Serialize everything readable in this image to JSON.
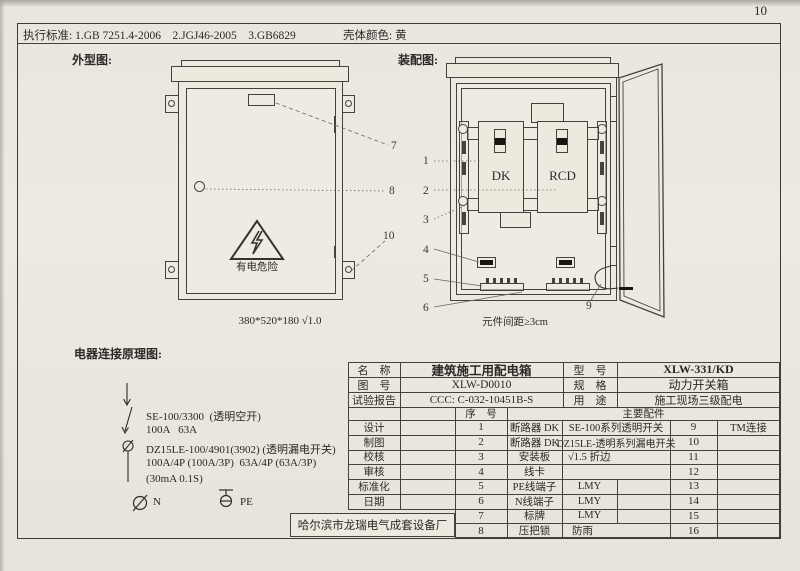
{
  "page": {
    "number": "10"
  },
  "header": {
    "standards": "执行标准: 1.GB 7251.4-2006    2.JGJ46-2005    3.GB6829",
    "shell_color": "壳体颜色: 黄"
  },
  "exterior": {
    "title": "外型图:",
    "warning": "有电危险",
    "dimension": "380*520*180 √1.0"
  },
  "assembly": {
    "title": "装配图:",
    "dk": "DK",
    "rcd": "RCD",
    "note": "元件间距≥3cm"
  },
  "callouts": {
    "c1": "1",
    "c2": "2",
    "c3": "3",
    "c4": "4",
    "c5": "5",
    "c6": "6",
    "c7": "7",
    "c8": "8",
    "c9": "9",
    "c10": "10"
  },
  "schematic": {
    "title": "电器连接原理图:",
    "lines": [
      "SE-100/3300  (透明空开)",
      "100A   63A",
      "DZ15LE-100/4901(3902) (透明漏电开关)",
      "100A/4P (100A/3P)  63A/4P (63A/3P)",
      "(30mA 0.1S)"
    ],
    "n": "N",
    "pe": "PE"
  },
  "factory": {
    "name": "哈尔滨市龙瑞电气成套设备厂"
  },
  "spec_table": {
    "info_rows": [
      {
        "label": "名　称",
        "value": "建筑施工用配电箱",
        "label2": "型　号",
        "value2": "XLW-331/KD"
      },
      {
        "label": "图　号",
        "value": "XLW-D0010",
        "label2": "规　格",
        "value2": "动力开关箱"
      },
      {
        "label": "试验报告",
        "value": "CCC: C-032-10451B-S",
        "label2": "用　途",
        "value2": "施工现场三级配电"
      }
    ],
    "seq_header": "序　号",
    "parts_header": "主要配件",
    "signature_labels": [
      "设计",
      "制图",
      "校核",
      "审核",
      "标准化",
      "日期"
    ],
    "parts": [
      {
        "no": "1",
        "name": "断路器 DK",
        "desc": "SE-100系列透明开关",
        "no2": "9",
        "desc2": "TM连接"
      },
      {
        "no": "2",
        "name": "断路器 DK",
        "desc": "DZ15LE-透明系列漏电开关",
        "no2": "10",
        "desc2": ""
      },
      {
        "no": "3",
        "name": "安装板",
        "desc": "√1.5 折边",
        "no2": "11",
        "desc2": ""
      },
      {
        "no": "4",
        "name": "线卡",
        "desc": "",
        "no2": "12",
        "desc2": ""
      },
      {
        "no": "5",
        "name": "PE线端子",
        "desc": "LMY",
        "no2": "13",
        "desc2": ""
      },
      {
        "no": "6",
        "name": "N线端子",
        "desc": "LMY",
        "no2": "14",
        "desc2": ""
      },
      {
        "no": "7",
        "name": "标牌",
        "desc": "LMY",
        "no2": "15",
        "desc2": ""
      },
      {
        "no": "8",
        "name": "压把锁",
        "desc": "防雨",
        "no2": "16",
        "desc2": ""
      }
    ]
  }
}
